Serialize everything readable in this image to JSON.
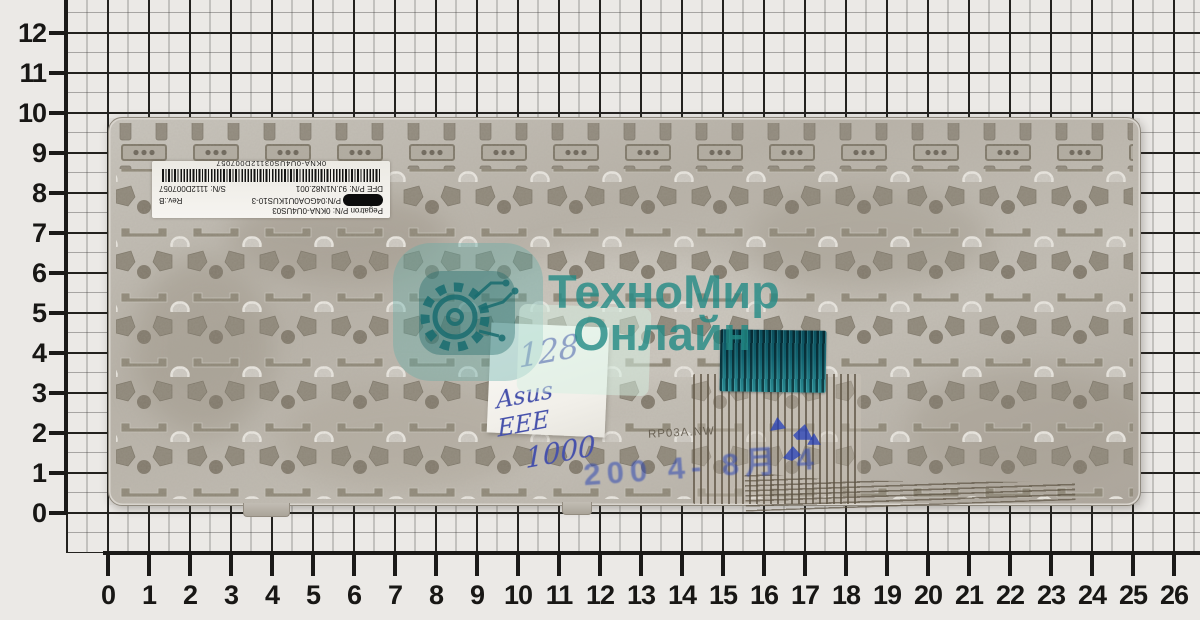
{
  "page": {
    "background": "#ebe9e6",
    "description_units": "cm"
  },
  "rulers": {
    "left_labels": [
      "12",
      "11",
      "10",
      "9",
      "8",
      "7",
      "6",
      "5",
      "4",
      "3",
      "2",
      "1",
      "0"
    ],
    "bottom_labels": [
      "0",
      "1",
      "2",
      "3",
      "4",
      "5",
      "6",
      "7",
      "8",
      "9",
      "10",
      "11",
      "12",
      "13",
      "14",
      "15",
      "16",
      "17",
      "18",
      "19",
      "20",
      "21",
      "22",
      "23",
      "24",
      "25",
      "26"
    ]
  },
  "keyboard": {
    "part_label": {
      "line1": "Pegatron P/N: 0KNA-0U4US03",
      "line2": "P/N:04GOA0U1KUS10-3",
      "line2_rev": "Rev.:B",
      "line3": "DFE P/N: 9J.N1N82.001",
      "line3_sn": "S/N: 1112D007057",
      "barcode_text": "0KNA-0U4US03112D007057"
    },
    "handwritten_note": {
      "line1": "128",
      "line2": "Asus EEE",
      "line3": "1000",
      "ink_color": "#4651ab"
    },
    "date_stamp": "200 4- 8月 4",
    "flex_marking": "RP03A.NW"
  },
  "watermark": {
    "line1": "ТехноМир",
    "line2": "Онлайн",
    "color": "#228a84"
  }
}
